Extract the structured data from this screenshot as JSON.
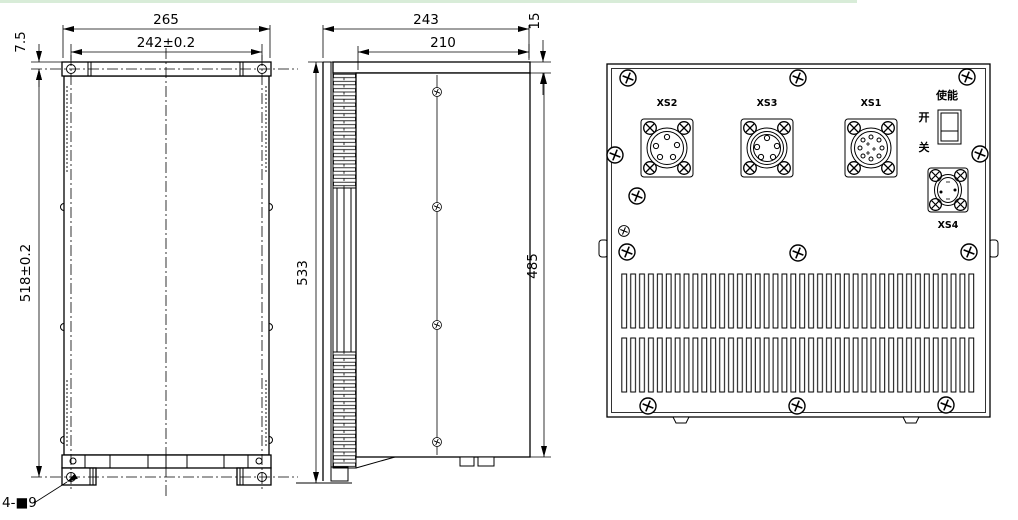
{
  "drawing": {
    "front_view": {
      "dim_width_outer": "265",
      "dim_width_holes": "242±0.2",
      "dim_height": "518±0.2",
      "dim_top_offset": "7.5",
      "hole_callout": "4-■9"
    },
    "side_view": {
      "dim_depth_outer": "243",
      "dim_depth_body": "210",
      "dim_height_outer": "533",
      "dim_height_body": "485",
      "dim_top_lip": "15"
    },
    "rear_view": {
      "connector_xs2": "XS2",
      "connector_xs3": "XS3",
      "connector_xs1": "XS1",
      "connector_xs4": "XS4",
      "switch_title": "使能",
      "switch_on": "开",
      "switch_off": "关"
    },
    "colors": {
      "line": "#000000",
      "background": "#ffffff",
      "top_strip": "#d8ecd8"
    }
  }
}
